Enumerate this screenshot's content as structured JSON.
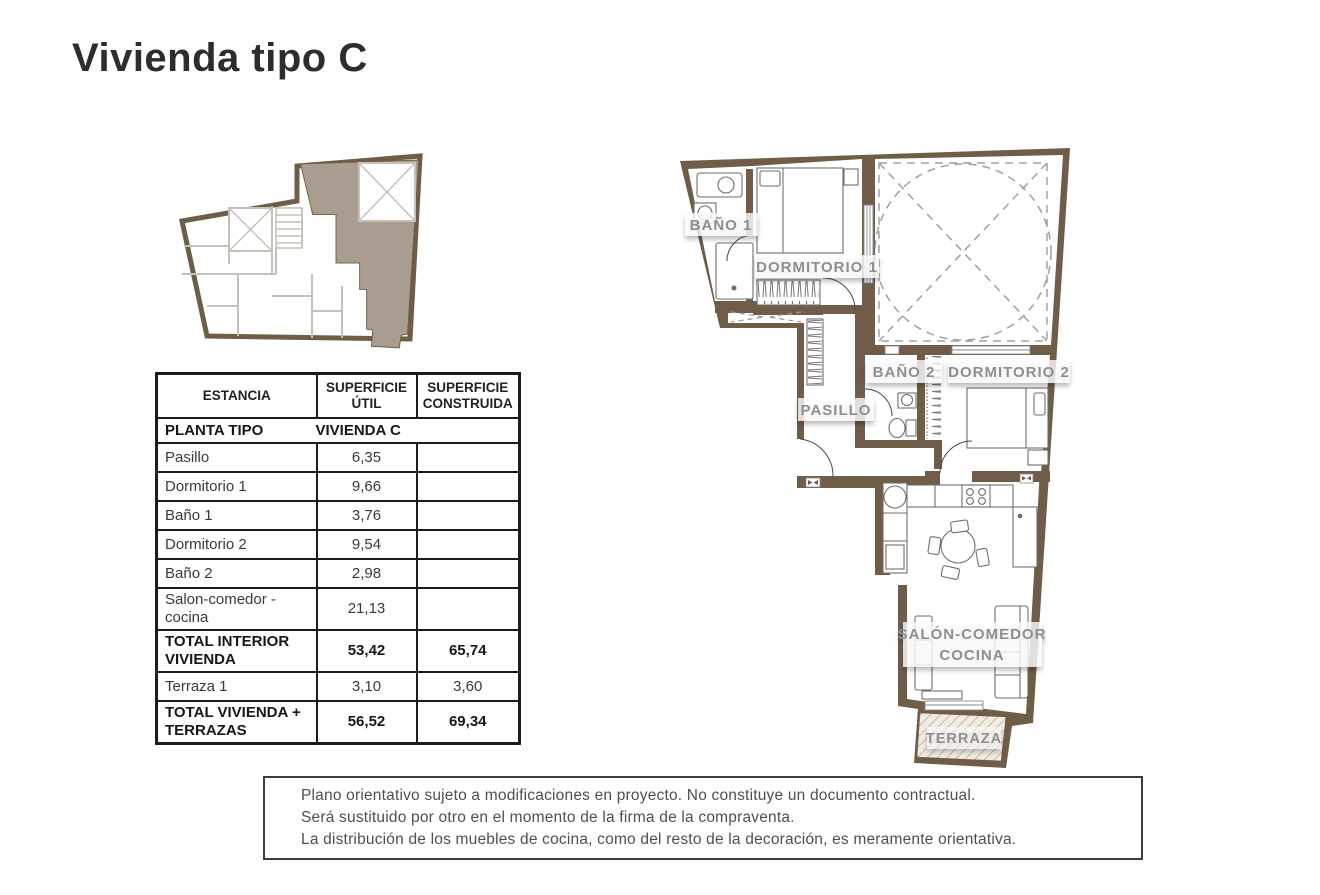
{
  "page": {
    "title": "Vivienda tipo C"
  },
  "area_table": {
    "headers": {
      "col1": "ESTANCIA",
      "col2": "SUPERFICIE ÚTIL",
      "col3": "SUPERFICIE CONSTRUIDA"
    },
    "section_row": {
      "left": "PLANTA TIPO",
      "right": "VIVIENDA C"
    },
    "rows": [
      {
        "name": "Pasillo",
        "util": "6,35",
        "built": ""
      },
      {
        "name": "Dormitorio 1",
        "util": "9,66",
        "built": ""
      },
      {
        "name": "Baño 1",
        "util": "3,76",
        "built": ""
      },
      {
        "name": "Dormitorio 2",
        "util": "9,54",
        "built": ""
      },
      {
        "name": "Baño 2",
        "util": "2,98",
        "built": ""
      },
      {
        "name": "Salon-comedor - cocina",
        "util": "21,13",
        "built": ""
      },
      {
        "name": "TOTAL INTERIOR VIVIENDA",
        "util": "53,42",
        "built": "65,74"
      },
      {
        "name": "Terraza 1",
        "util": "3,10",
        "built": "3,60"
      },
      {
        "name": "TOTAL VIVIENDA + TERRAZAS",
        "util": "56,52",
        "built": "69,34"
      }
    ]
  },
  "floorplan": {
    "labels": {
      "bano1": "BAÑO 1",
      "dormitorio1": "DORMITORIO 1",
      "bano2": "BAÑO 2",
      "dormitorio2": "DORMITORIO 2",
      "pasillo": "PASILLO",
      "salon_line1": "SALÓN-COMEDOR",
      "salon_line2": "COCINA",
      "terraza": "TERRAZA"
    }
  },
  "disclaimer": {
    "line1": "Plano orientativo sujeto a modificaciones en proyecto. No constituye un documento contractual.",
    "line2": "Será sustituido por otro en el momento de la firma de la compraventa.",
    "line3": "La distribución de los muebles de cocina, como del resto de la decoración, es meramente orientativa."
  },
  "colors": {
    "wall_brown": "#6F5D48",
    "unit_highlight": "#A89D90",
    "keyplan_wall_gray": "#C6C1B8",
    "label_gray": "#8F8F8F",
    "terraza_hatch": "#B9AD9B"
  }
}
